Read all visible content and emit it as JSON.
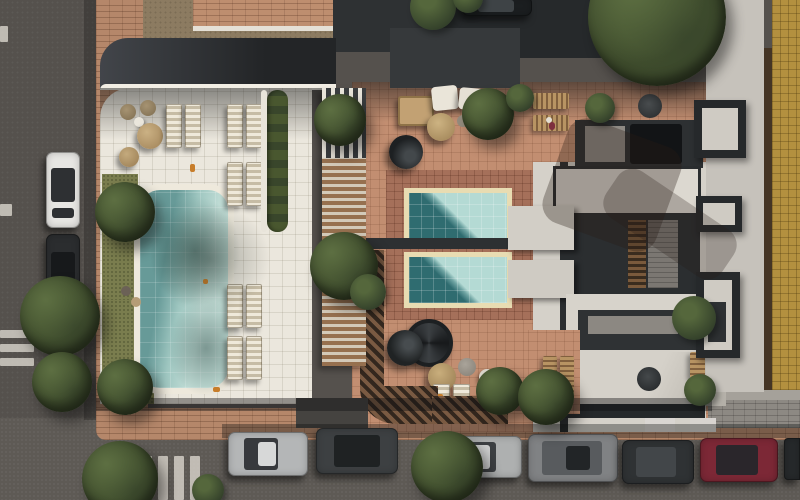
{
  "scene": {
    "type": "aerial-architectural-render",
    "view": "top-down",
    "description": "Daytime bird's-eye 3D render of a residential block with a rooftop amenity deck: one long lap pool on a white tiled sun deck, two plunge pools on a terracotta terrace, a slatted pergola, gray modern roof volumes with skylight wells, street parking on two streets, crosswalks and mature trees",
    "time_of_day": "day",
    "visible_text": ""
  },
  "palette": {
    "asphalt": "#55514d",
    "asphalt_bottom": "#5e5a55",
    "sidewalk_brick": "#b5876a",
    "gray_paving": "#8d8983",
    "deck_tile": "#ebe7dd",
    "terrace_tile": "#c28e71",
    "terrace_apron": "#a5705a",
    "pergola_wood": "#96704f",
    "lap_pool_water_light": "#c1ddd6",
    "lap_pool_water_shade": "#679a98",
    "plunge_pool_water_light": "#aed6d0",
    "plunge_pool_water_deep": "#2f6c70",
    "pool_coping_white": "#eee9dc",
    "pool_coping_cream": "#e8dcb2",
    "grass": "#7a7d4e",
    "foliage": "#47562f",
    "roof_dark": "#2d3032",
    "roof_concrete": "#c6c2bb",
    "roof_cream": "#d5d1c9",
    "tan_building": "#b3903f",
    "crosswalk_paint": "#d2cec6"
  },
  "areas": {
    "left_street": {
      "orientation": "vertical",
      "features": [
        "lane dashes",
        "zebra crosswalk",
        "2 parallel-parked cars"
      ]
    },
    "bottom_street": {
      "orientation": "horizontal",
      "features": [
        "zebra crosswalk",
        "7 parallel-parked cars",
        "street trees"
      ]
    },
    "pool_deck": {
      "floor": "white tile",
      "features": [
        "lap pool",
        "10 sun loungers",
        "2 round daybeds",
        "rattan seating",
        "lawn strips"
      ]
    },
    "central_terrace": {
      "floor": "terracotta tile",
      "features": [
        "2 plunge pools",
        "outdoor sofas",
        "parasols",
        "round daybed",
        "spiral staircase",
        "planting"
      ]
    },
    "right_roofs": {
      "floor": "concrete and charcoal volumes",
      "features": [
        "skylight wells",
        "stair core",
        "roof terraces with furniture"
      ]
    },
    "neighbor_building_right": {
      "facade": "tan brick"
    }
  },
  "pools": [
    {
      "name": "lap-pool",
      "shape": "rounded rectangle",
      "coping": "#eee9dc",
      "water": [
        "#c1ddd6",
        "#679a98"
      ]
    },
    {
      "name": "plunge-pool-north",
      "shape": "rectangle",
      "coping": "#e8dcb2",
      "water": [
        "#aed6d0",
        "#2f6c70"
      ]
    },
    {
      "name": "plunge-pool-south",
      "shape": "rectangle",
      "coping": "#e8dcb2",
      "water": [
        "#aed6d0",
        "#2f6c70"
      ]
    }
  ],
  "vehicles": {
    "left_street": [
      {
        "color_name": "white",
        "hex": "#e7e6e3"
      },
      {
        "color_name": "dark-gray",
        "hex": "#2b2d2f"
      }
    ],
    "top_edge": [
      {
        "color_name": "black",
        "hex": "#1b1e20",
        "note": "partially out of frame"
      }
    ],
    "bottom_street": [
      {
        "color_name": "silver",
        "hex": "#b4b6b7"
      },
      {
        "color_name": "dark-gray",
        "hex": "#3d4042"
      },
      {
        "color_name": "silver",
        "hex": "#aeb0b0"
      },
      {
        "color_name": "gray-suv",
        "hex": "#808284"
      },
      {
        "color_name": "charcoal",
        "hex": "#2f3234"
      },
      {
        "color_name": "dark-red",
        "hex": "#7c2836"
      },
      {
        "color_name": "dark",
        "hex": "#26292b",
        "note": "clipped at right edge"
      }
    ]
  },
  "landscaping": {
    "large_tree_top_right": 1,
    "street_trees": 6,
    "deck_and_terrace_trees": 9,
    "planter_hedge": 1
  },
  "markings": {
    "crosswalks": 2,
    "lane_dashes": 2
  }
}
